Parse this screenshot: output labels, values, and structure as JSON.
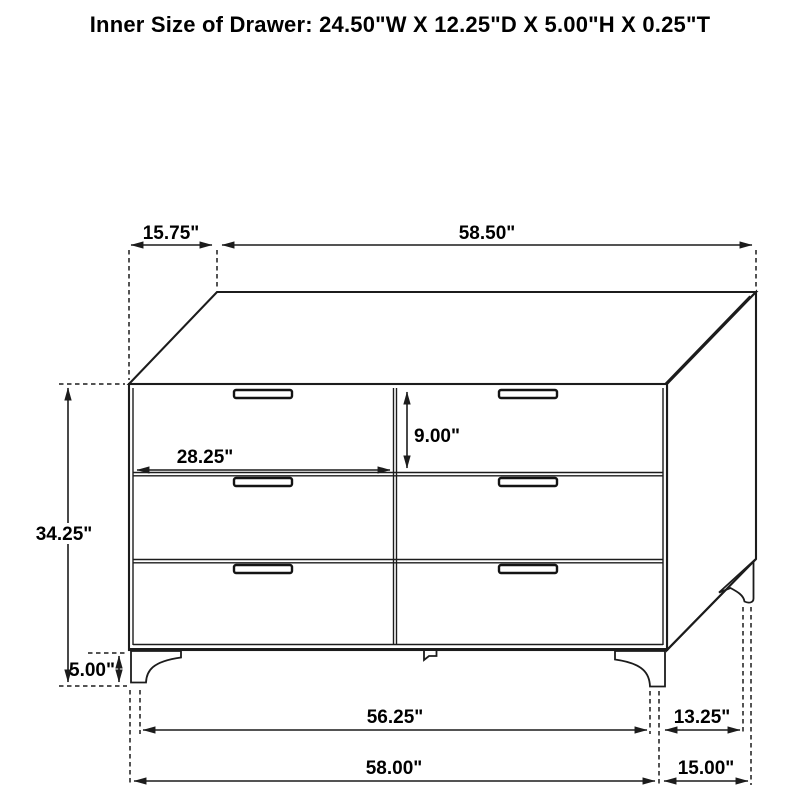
{
  "title": "Inner Size of Drawer: 24.50\"W X 12.25\"D X 5.00\"H X 0.25\"T",
  "dimensions": {
    "top_depth": "15.75\"",
    "top_width": "58.50\"",
    "overall_height": "34.25\"",
    "leg_height": "5.00\"",
    "drawer_width": "28.25\"",
    "drawer_height": "9.00\"",
    "base_inner_width": "56.25\"",
    "base_inner_depth": "13.25\"",
    "base_width": "58.00\"",
    "base_depth": "15.00\""
  },
  "colors": {
    "line": "#1c1c1c",
    "text": "#000000",
    "background": "#ffffff"
  }
}
